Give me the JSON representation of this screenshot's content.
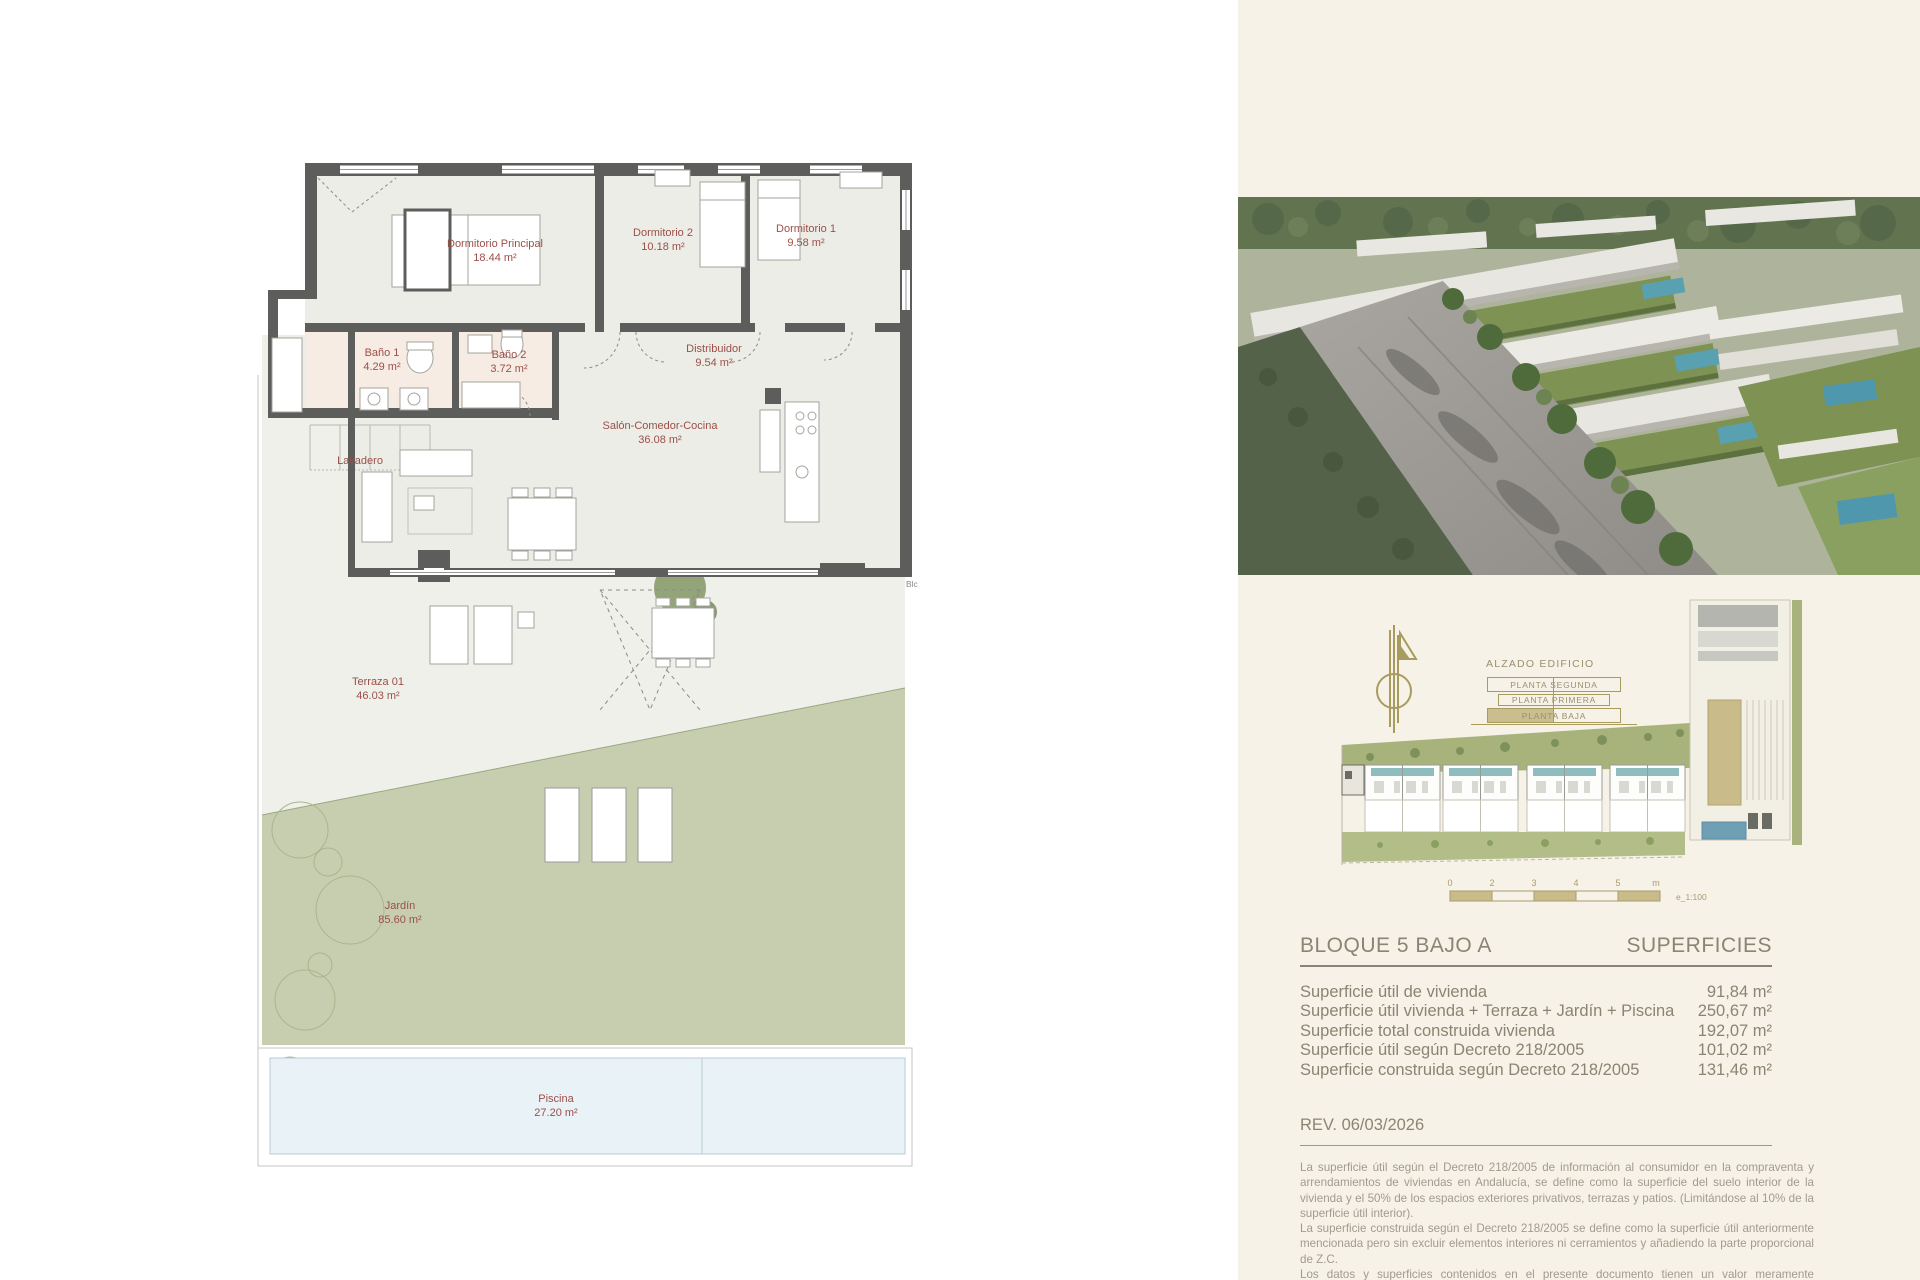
{
  "floor_plan": {
    "rooms": [
      {
        "name": "Dormitorio Principal",
        "area": "18.44 m²"
      },
      {
        "name": "Dormitorio 2",
        "area": "10.18 m²"
      },
      {
        "name": "Dormitorio 1",
        "area": "9.58 m²"
      },
      {
        "name": "Baño 1",
        "area": "4.29 m²"
      },
      {
        "name": "Baño 2",
        "area": "3.72 m²"
      },
      {
        "name": "Distribuidor",
        "area": "9.54 m²"
      },
      {
        "name": "Salón-Comedor-Cocina",
        "area": "36.08 m²"
      },
      {
        "name": "Lavadero",
        "area": ""
      },
      {
        "name": "Terraza 01",
        "area": "46.03 m²"
      },
      {
        "name": "Jardín",
        "area": "85.60 m²"
      },
      {
        "name": "Piscina",
        "area": "27.20 m²"
      }
    ],
    "side_label": "Blc"
  },
  "panel": {
    "alzado": {
      "title": "ALZADO EDIFICIO",
      "levels": [
        "PLANTA SEGUNDA",
        "PLANTA PRIMERA",
        "PLANTA BAJA"
      ]
    },
    "scale_bar": {
      "ticks": [
        "0",
        "2",
        "3",
        "4",
        "5",
        "m"
      ],
      "scale": "e_1:100"
    },
    "superficies": {
      "block": "BLOQUE 5 BAJO A",
      "title": "SUPERFICIES",
      "rows": [
        {
          "label": "Superficie útil de vivienda",
          "value": "91,84 m²"
        },
        {
          "label": "Superficie útil vivienda + Terraza + Jardín + Piscina",
          "value": "250,67 m²"
        },
        {
          "label": "Superficie total construida vivienda",
          "value": "192,07 m²"
        },
        {
          "label": "Superficie útil según Decreto 218/2005",
          "value": "101,02 m²"
        },
        {
          "label": "Superficie construida según Decreto 218/2005",
          "value": "131,46 m²"
        }
      ],
      "revision": "REV. 06/03/2026"
    },
    "disclaimer": {
      "p1": "La superficie útil según el Decreto 218/2005 de información al consumidor en la compraventa y arrendamientos de viviendas en Andalucía, se define como la superficie del suelo interior de la vivienda y el 50% de los espacios exteriores privativos, terrazas y patios. (Limitándose al 10% de la superficie útil interior).",
      "p2": "La superficie construida según el Decreto 218/2005 se define como la superficie útil anteriormente mencionada pero sin excluir elementos interiores ni cerramientos y añadiendo la parte proporcional de Z.C.",
      "p3": "Los datos y superficies contenidos en el presente documento tienen un valor meramente informativo, que pudiera estar sujeto a cambios por parte de la empresa o la dirección técnica. Puertas, aperturas, sanitarios o distribución no son vinculantes. Mobiliario, colores, texturas o solería son únicamente gráficos orientativos, por lo que esta documentación",
      "p4": "no puede ser considerada documento contractual."
    }
  },
  "colors": {
    "panel_bg": "#f6f2e7",
    "gold": "#a79b5e",
    "tan": "#cbbe8e",
    "olive_text": "#8c8472",
    "maroon": "#9c4f49",
    "garden": "#c7ceb0",
    "pool": "#e8f2f7",
    "wall": "#5d5d5c",
    "muted": "#a29b8d"
  }
}
